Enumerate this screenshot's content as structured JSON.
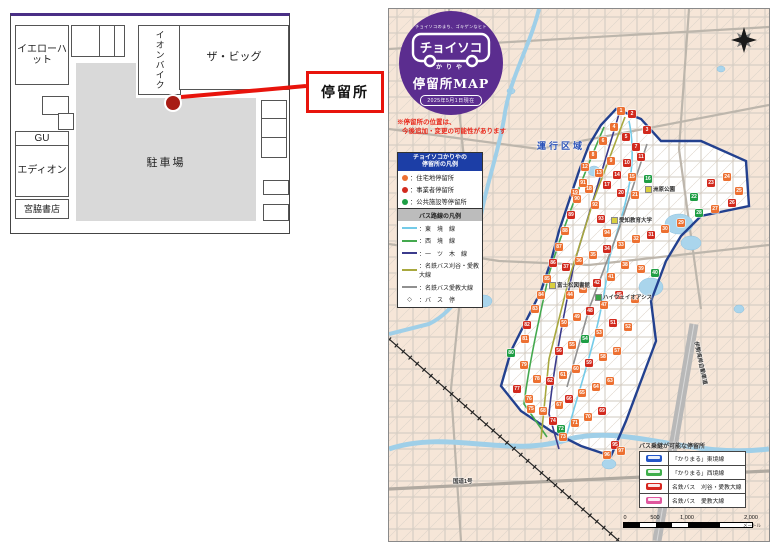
{
  "site_map": {
    "stores": {
      "yellow_hat": "イエローハット",
      "gu": "GU",
      "edion": "エディオン",
      "miyawaki": "宮脇書店",
      "aeon_bike": "イオンバイク",
      "the_big": "ザ・ビッグ"
    },
    "parking_label": "駐車場",
    "stop_label": "停留所"
  },
  "logo": {
    "tagline": "チョイソコのまち、ゴキゲンなヒト",
    "name": "チョイソコ",
    "city": "かりや",
    "map_title": "停留所MAP",
    "date": "2025年5月1日現在"
  },
  "map": {
    "notice_line1": "※停留所の位置は、",
    "notice_line2": "今後追加・変更の可能性があります",
    "area_label": {
      "t": "運行区域",
      "x": 148,
      "y": 130
    },
    "labels": [
      {
        "t": "洲原公園",
        "x": 256,
        "y": 176,
        "ic": "#d9cf3e"
      },
      {
        "t": "愛知教育大学",
        "x": 222,
        "y": 207,
        "ic": "#d9cf3e"
      },
      {
        "t": "富士松図書館",
        "x": 160,
        "y": 272,
        "ic": "#d9cf3e"
      },
      {
        "t": "ハイウェイオアシス",
        "x": 206,
        "y": 284,
        "ic": "#3aa54a"
      },
      {
        "t": "伊勢湾岸自動車道",
        "x": 290,
        "y": 350,
        "rot": 78
      },
      {
        "t": "国道1号",
        "x": 64,
        "y": 468
      }
    ],
    "markers": [
      [
        1,
        "o",
        232,
        102
      ],
      [
        2,
        "r",
        243,
        105
      ],
      [
        3,
        "r",
        258,
        121
      ],
      [
        4,
        "o",
        225,
        118
      ],
      [
        5,
        "r",
        237,
        128
      ],
      [
        6,
        "o",
        214,
        132
      ],
      [
        7,
        "r",
        247,
        138
      ],
      [
        8,
        "o",
        204,
        146
      ],
      [
        9,
        "o",
        222,
        152
      ],
      [
        10,
        "r",
        238,
        154
      ],
      [
        11,
        "r",
        252,
        148
      ],
      [
        12,
        "o",
        196,
        158
      ],
      [
        13,
        "o",
        210,
        164
      ],
      [
        14,
        "r",
        228,
        166
      ],
      [
        15,
        "o",
        243,
        168
      ],
      [
        16,
        "g",
        259,
        170
      ],
      [
        17,
        "r",
        218,
        176
      ],
      [
        18,
        "o",
        200,
        180
      ],
      [
        19,
        "o",
        186,
        184
      ],
      [
        20,
        "r",
        232,
        184
      ],
      [
        21,
        "o",
        246,
        186
      ],
      [
        22,
        "g",
        305,
        188
      ],
      [
        23,
        "r",
        322,
        174
      ],
      [
        24,
        "o",
        338,
        168
      ],
      [
        25,
        "o",
        350,
        182
      ],
      [
        26,
        "r",
        343,
        194
      ],
      [
        27,
        "o",
        326,
        200
      ],
      [
        28,
        "g",
        310,
        204
      ],
      [
        29,
        "o",
        292,
        214
      ],
      [
        30,
        "o",
        276,
        220
      ],
      [
        31,
        "r",
        262,
        226
      ],
      [
        32,
        "o",
        247,
        230
      ],
      [
        33,
        "o",
        232,
        236
      ],
      [
        34,
        "r",
        218,
        240
      ],
      [
        35,
        "o",
        204,
        246
      ],
      [
        36,
        "o",
        190,
        252
      ],
      [
        37,
        "r",
        177,
        258
      ],
      [
        38,
        "o",
        236,
        256
      ],
      [
        39,
        "o",
        252,
        260
      ],
      [
        40,
        "g",
        266,
        264
      ],
      [
        41,
        "o",
        222,
        268
      ],
      [
        42,
        "r",
        208,
        274
      ],
      [
        43,
        "o",
        194,
        280
      ],
      [
        44,
        "o",
        181,
        286
      ],
      [
        45,
        "r",
        230,
        286
      ],
      [
        46,
        "o",
        246,
        290
      ],
      [
        47,
        "o",
        215,
        296
      ],
      [
        48,
        "r",
        201,
        302
      ],
      [
        49,
        "o",
        188,
        308
      ],
      [
        50,
        "o",
        175,
        314
      ],
      [
        51,
        "r",
        224,
        314
      ],
      [
        52,
        "o",
        239,
        318
      ],
      [
        53,
        "o",
        210,
        324
      ],
      [
        54,
        "g",
        196,
        330
      ],
      [
        55,
        "o",
        183,
        336
      ],
      [
        56,
        "r",
        170,
        342
      ],
      [
        57,
        "o",
        228,
        342
      ],
      [
        58,
        "o",
        214,
        348
      ],
      [
        59,
        "r",
        200,
        354
      ],
      [
        60,
        "o",
        187,
        360
      ],
      [
        61,
        "o",
        174,
        366
      ],
      [
        62,
        "r",
        161,
        372
      ],
      [
        63,
        "o",
        221,
        372
      ],
      [
        64,
        "o",
        207,
        378
      ],
      [
        65,
        "o",
        193,
        384
      ],
      [
        66,
        "r",
        180,
        390
      ],
      [
        67,
        "o",
        170,
        396
      ],
      [
        68,
        "o",
        154,
        402
      ],
      [
        69,
        "r",
        213,
        402
      ],
      [
        70,
        "o",
        199,
        408
      ],
      [
        71,
        "o",
        186,
        414
      ],
      [
        72,
        "g",
        172,
        420
      ],
      [
        73,
        "o",
        174,
        428
      ],
      [
        74,
        "r",
        164,
        412
      ],
      [
        75,
        "o",
        142,
        400
      ],
      [
        76,
        "o",
        140,
        390
      ],
      [
        77,
        "r",
        128,
        380
      ],
      [
        78,
        "o",
        148,
        370
      ],
      [
        79,
        "o",
        135,
        356
      ],
      [
        80,
        "g",
        122,
        344
      ],
      [
        81,
        "o",
        136,
        330
      ],
      [
        82,
        "r",
        138,
        316
      ],
      [
        83,
        "o",
        146,
        300
      ],
      [
        84,
        "o",
        152,
        286
      ],
      [
        85,
        "o",
        158,
        270
      ],
      [
        86,
        "r",
        164,
        254
      ],
      [
        87,
        "o",
        170,
        238
      ],
      [
        88,
        "o",
        176,
        222
      ],
      [
        89,
        "r",
        182,
        206
      ],
      [
        90,
        "o",
        188,
        190
      ],
      [
        91,
        "o",
        194,
        174
      ],
      [
        92,
        "o",
        206,
        196
      ],
      [
        93,
        "r",
        212,
        210
      ],
      [
        94,
        "o",
        218,
        224
      ],
      [
        95,
        "r",
        226,
        436
      ],
      [
        96,
        "o",
        218,
        446
      ],
      [
        97,
        "o",
        232,
        442
      ]
    ]
  },
  "legends": {
    "stops": {
      "title1": "チョイソコかりやの",
      "title2": "停留所の凡例",
      "items": [
        {
          "color": "#ed7031",
          "label": "：住宅地停留所"
        },
        {
          "color": "#d22a1e",
          "label": "：事業者停留所"
        },
        {
          "color": "#1e9e44",
          "label": "：公共施設等停留所"
        }
      ]
    },
    "routes": {
      "title": "バス路線の凡例",
      "items": [
        {
          "color": "#74cbe8",
          "label": "：東　境　線"
        },
        {
          "color": "#44a94e",
          "label": "：西　境　線"
        },
        {
          "color": "#3b3b8c",
          "label": "：一　ツ　木　線"
        },
        {
          "color": "#a8a83e",
          "label": "：名鉄バス刈谷・愛教大線"
        },
        {
          "color": "#909090",
          "label": "：名鉄バス愛教大線"
        }
      ],
      "busstop_symbol": "◇",
      "busstop_label": "：バ　ス　停"
    },
    "transfer": {
      "title": "バス乗継が可能な停留所",
      "rows": [
        {
          "color": "#2356c8",
          "label": "「かりまる」東境線"
        },
        {
          "color": "#3fae4a",
          "label": "「かりまる」西境線"
        },
        {
          "color": "#d6261f",
          "label": "名鉄バス　刈谷・愛教大線"
        },
        {
          "color": "#e0579e",
          "label": "名鉄バス　愛教大線"
        }
      ]
    }
  },
  "scale": {
    "ticks": [
      "0",
      "500",
      "1,000",
      "2,000"
    ],
    "unit": "メートル"
  }
}
